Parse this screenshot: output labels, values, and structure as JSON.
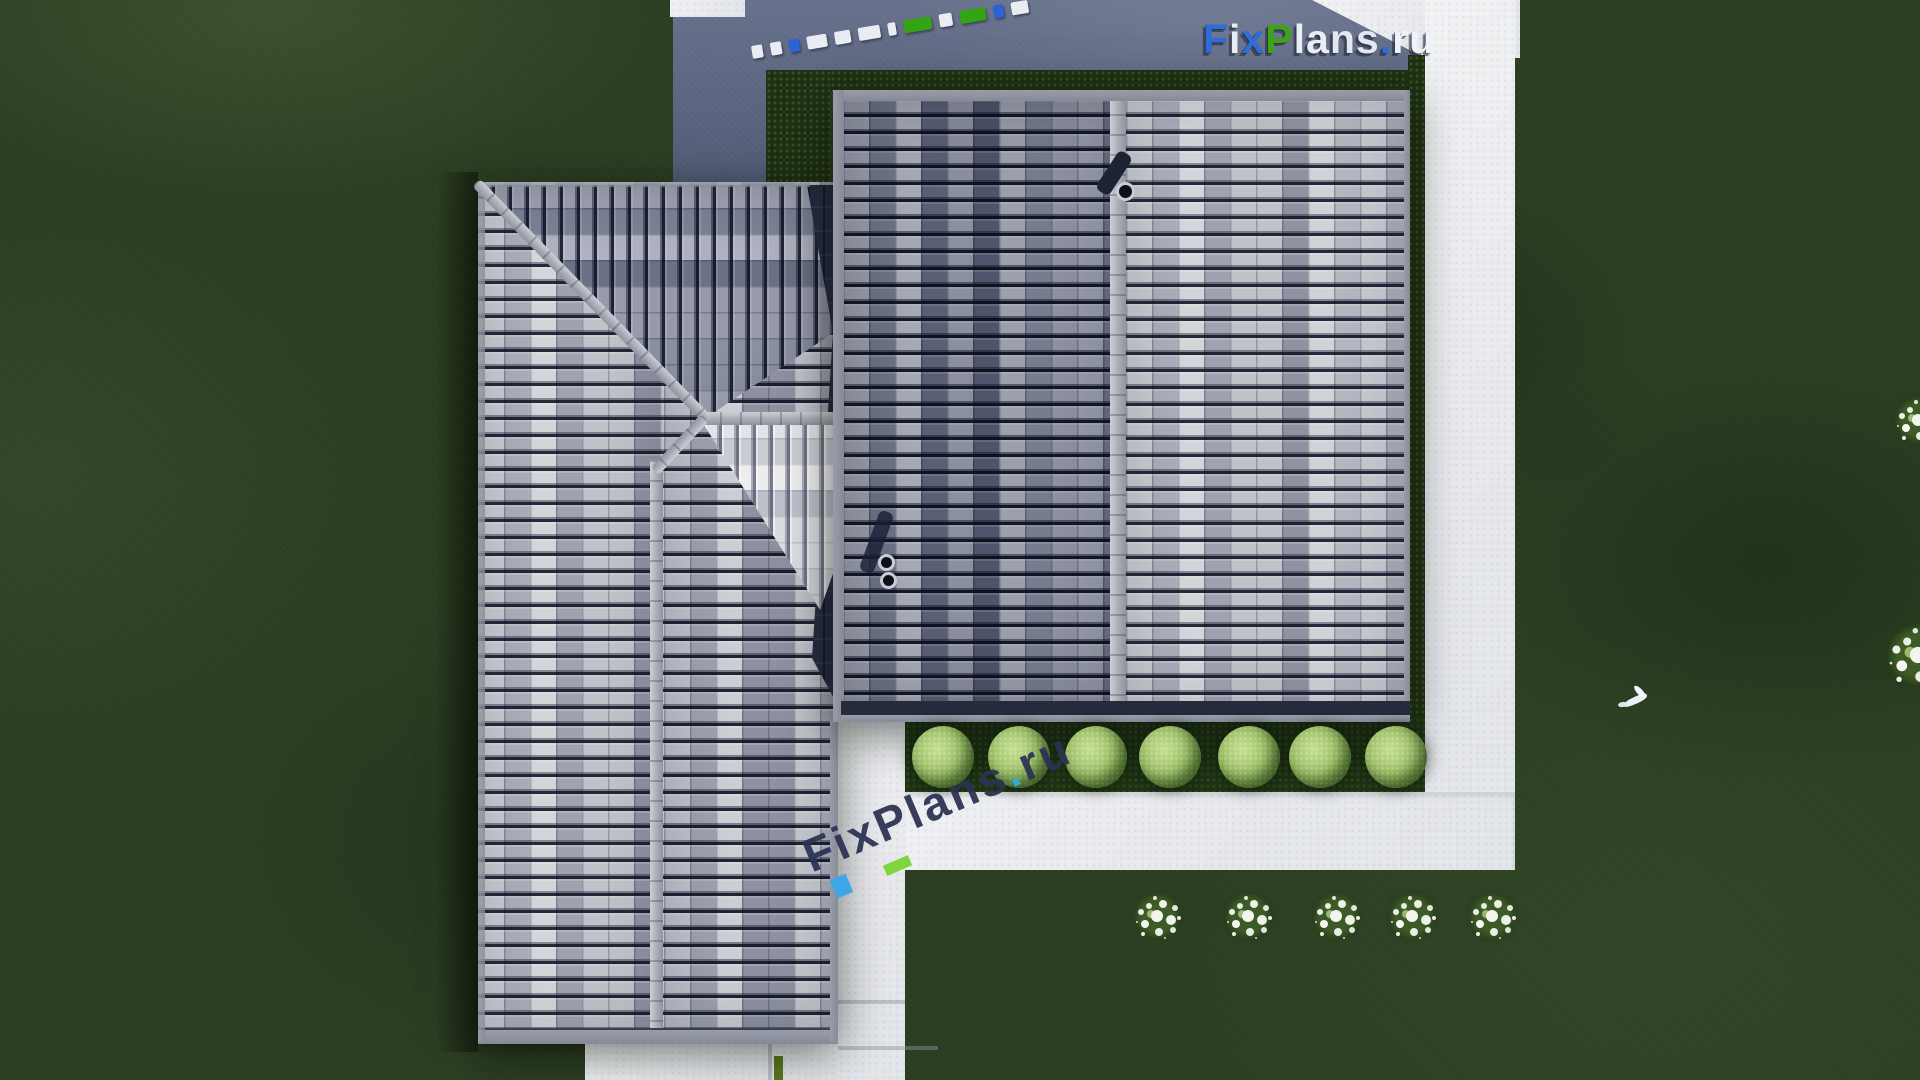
{
  "brand": "FixPlans.ru",
  "watermarks": {
    "logo_top_right": {
      "text": "FixPlans.ru",
      "letters": [
        [
          "F",
          "#2e6cd6"
        ],
        [
          "i",
          "#e9edf4"
        ],
        [
          "x",
          "#2e6cd6"
        ],
        [
          "P",
          "#3fa316"
        ],
        [
          "l",
          "#e9edf4"
        ],
        [
          "a",
          "#e9edf4"
        ],
        [
          "n",
          "#e2e7f0"
        ],
        [
          "s",
          "#e2e7f0"
        ],
        [
          ".",
          "#2e6cd6"
        ],
        [
          "r",
          "#eff2f6"
        ],
        [
          "u",
          "#eff2f6"
        ]
      ],
      "shadow_color": "#252c44"
    },
    "center_rotated": {
      "text": "FixPlans.ru",
      "letters": [
        [
          "F",
          "#2c3353"
        ],
        [
          "i",
          "#2c3353"
        ],
        [
          "x",
          "#2c3353"
        ],
        [
          "P",
          "#2c3353"
        ],
        [
          "l",
          "#2c3353"
        ],
        [
          "a",
          "#2c3353"
        ],
        [
          "n",
          "#2c3353"
        ],
        [
          "s",
          "#2c3353"
        ],
        [
          ".",
          "#36a9de"
        ],
        [
          "r",
          "#2c3353"
        ],
        [
          "u",
          "#2c3353"
        ]
      ],
      "accent_blue": "#3fa7e8",
      "accent_green": "#7ed63a"
    },
    "top_edge_dashes": {
      "colors": [
        "#e9edf3",
        "#e9edf3",
        "#2c63d8",
        "#e9edf3",
        "#e9edf3",
        "#e9edf3",
        "#e9edf3",
        "#35a316",
        "#e9edf3",
        "#35a316",
        "#2c63d8",
        "#e9edf3"
      ],
      "widths": [
        16,
        18,
        15,
        30,
        24,
        34,
        12,
        42,
        20,
        40,
        15,
        26
      ]
    }
  },
  "palette": {
    "grass_base": "#2c3e22",
    "driveway_blue_gray": "#5d6781",
    "path_white": "#e9ebee",
    "roof_light_gray": "#b9bcc3",
    "roof_dark_gray": "#8d91a0",
    "roof_bright_sunlit": "#d8d9dd",
    "roof_shadow_navy": "#252c42",
    "ridge_gray": "#a8acb5",
    "bush_green": "#9cc065",
    "flower_white": "#f2f5ee"
  },
  "garden": {
    "round_bushes": {
      "count": 7,
      "y": 757,
      "r": 31,
      "xs": [
        943,
        1019,
        1096,
        1170,
        1249,
        1320,
        1396
      ]
    },
    "flower_bushes": {
      "count": 5,
      "y": 916,
      "xs": [
        1157,
        1248,
        1336,
        1412,
        1492
      ]
    },
    "edge_flower_clusters": [
      {
        "y": 420,
        "scale": 1.0
      },
      {
        "y": 655,
        "scale": 1.35
      }
    ],
    "bird": {
      "x": 1622,
      "y": 688
    }
  }
}
